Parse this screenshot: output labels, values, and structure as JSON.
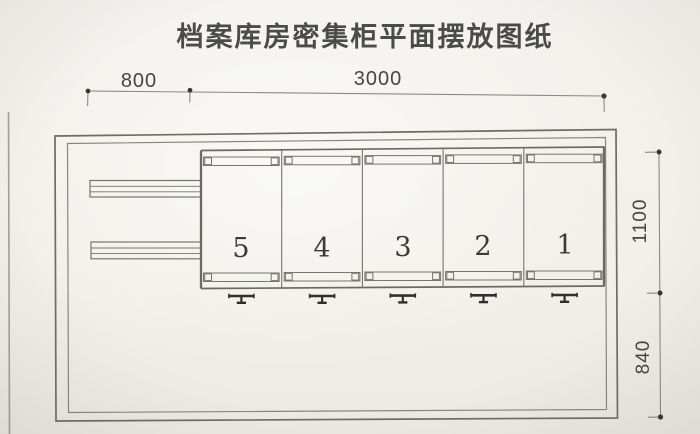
{
  "drawing": {
    "title": "档案库房密集柜平面摆放图纸",
    "top_dimensions": {
      "segments": [
        {
          "label": "800"
        },
        {
          "label": "3000"
        }
      ]
    },
    "right_dimensions": {
      "segments": [
        {
          "label": "1100"
        },
        {
          "label": "840"
        }
      ]
    },
    "cabinets": {
      "bays": [
        {
          "number": "5"
        },
        {
          "number": "4"
        },
        {
          "number": "3"
        },
        {
          "number": "2"
        },
        {
          "number": "1"
        }
      ]
    },
    "symbols": {
      "track_stop": "track-stop-symbol",
      "dimension_tick": "dimension-tick-dot"
    },
    "colors": {
      "paper": "#f2f0ea",
      "wall_line": "#6d6d67",
      "light_line": "#8a8a83",
      "dark_mark": "#343432",
      "text": "#454543"
    }
  }
}
